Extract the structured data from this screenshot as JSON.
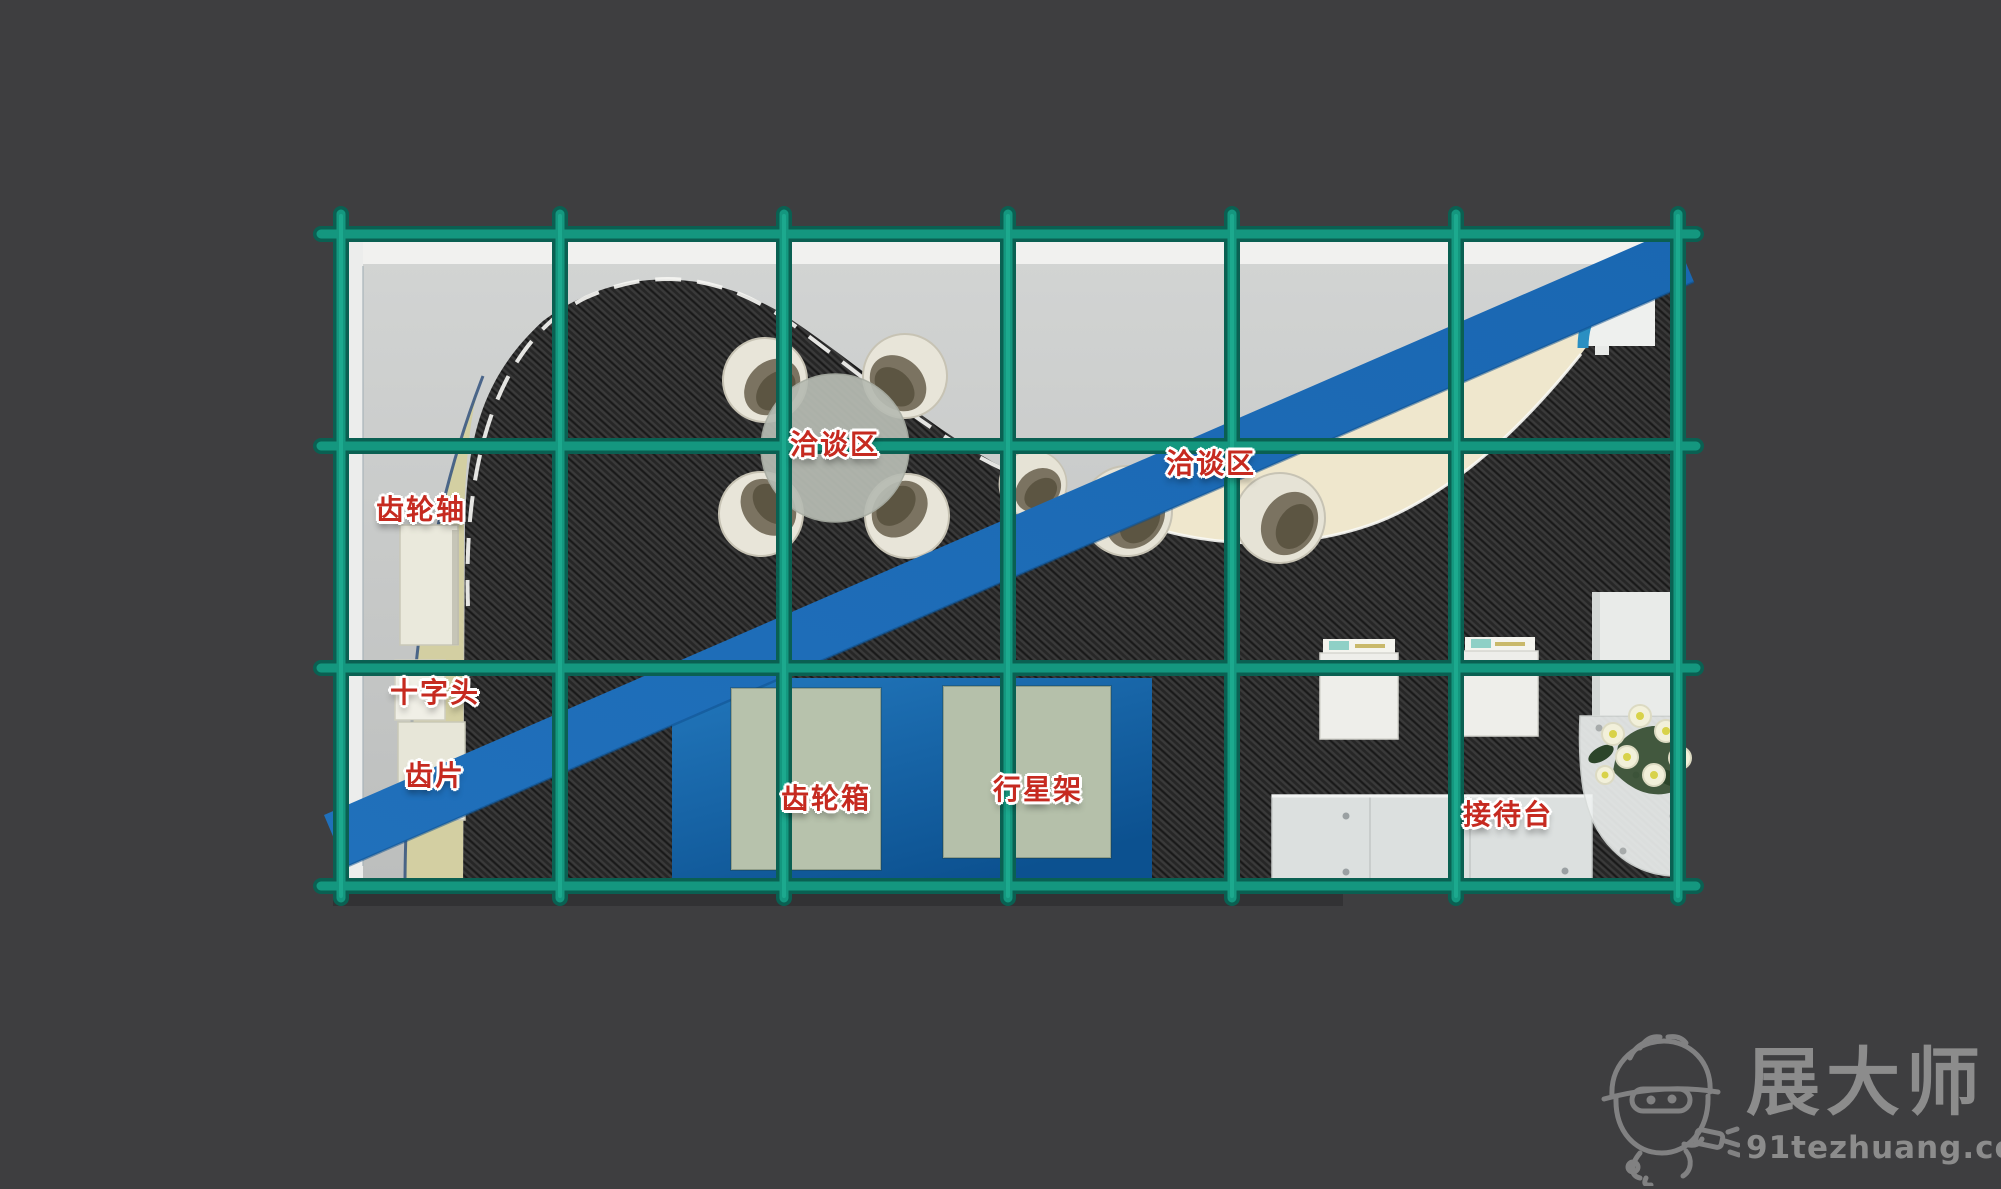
{
  "page": {
    "background_color": "#3e3e40",
    "type": "exhibition-booth-floorplan-top-view"
  },
  "booth": {
    "labels": [
      {
        "id": "gear-shaft",
        "text": "齿轮轴"
      },
      {
        "id": "crosshead",
        "text": "十字头"
      },
      {
        "id": "gear-piece",
        "text": "齿片"
      },
      {
        "id": "negotiation-area-1",
        "text": "洽谈区"
      },
      {
        "id": "negotiation-area-2",
        "text": "洽谈区"
      },
      {
        "id": "gearbox",
        "text": "齿轮箱"
      },
      {
        "id": "planet-carrier",
        "text": "行星架"
      },
      {
        "id": "reception-desk",
        "text": "接待台"
      }
    ],
    "colors": {
      "grid_teal": "#14977f",
      "grid_teal_edge": "#0a6052",
      "stripe_blue": "#1b6ab4",
      "label_red": "#c62a20",
      "carpet_dark": "#262626",
      "floor_gray": "#c6c8c7",
      "cream_arc": "#efe7cd",
      "platform_blue": "#1167a8",
      "display_green": "#b7c2ac",
      "stand_tan": "#d3cfa2"
    }
  },
  "watermark": {
    "brand": "展大师",
    "site": "91tezhuang.com",
    "mascot_icon": "hardhat-mascot-drill-icon"
  }
}
